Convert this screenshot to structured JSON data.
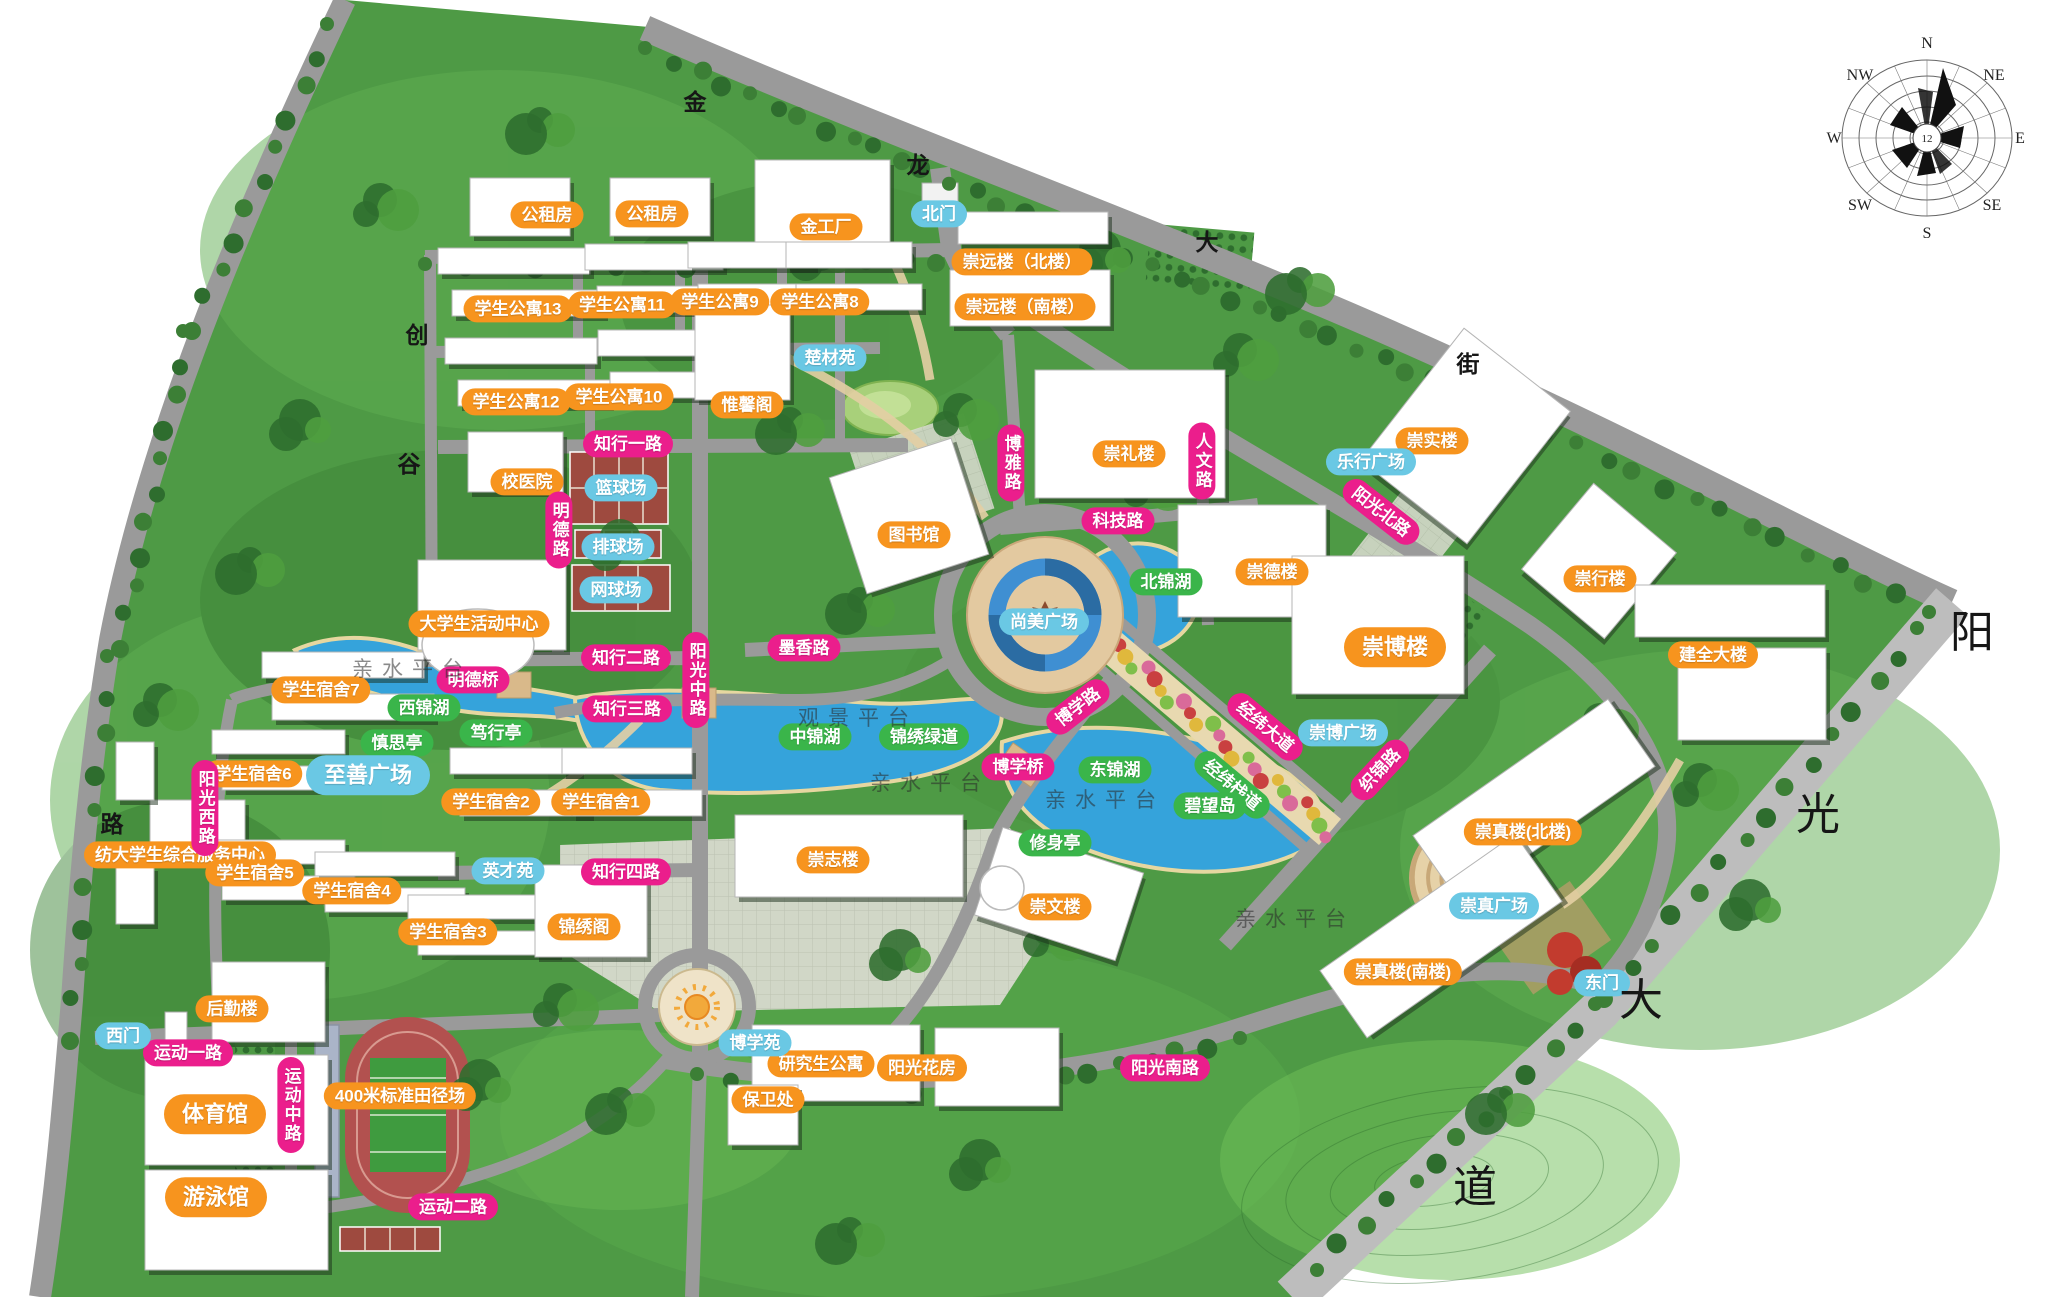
{
  "compass": {
    "directions": [
      "N",
      "NE",
      "E",
      "SE",
      "S",
      "SW",
      "W",
      "NW"
    ],
    "center_value": "12"
  },
  "labels": {
    "buildings": [
      {
        "t": "公租房",
        "x": 547,
        "y": 215
      },
      {
        "t": "公租房",
        "x": 652,
        "y": 214
      },
      {
        "t": "金工厂",
        "x": 826,
        "y": 227
      },
      {
        "t": "学生公寓13",
        "x": 518,
        "y": 309
      },
      {
        "t": "学生公寓11",
        "x": 622,
        "y": 305
      },
      {
        "t": "学生公寓9",
        "x": 720,
        "y": 302
      },
      {
        "t": "学生公寓8",
        "x": 820,
        "y": 302
      },
      {
        "t": "崇远楼（北楼）",
        "x": 1022,
        "y": 262
      },
      {
        "t": "崇远楼（南楼）",
        "x": 1025,
        "y": 307
      },
      {
        "t": "学生公寓12",
        "x": 516,
        "y": 402
      },
      {
        "t": "学生公寓10",
        "x": 619,
        "y": 397
      },
      {
        "t": "惟馨阁",
        "x": 747,
        "y": 405
      },
      {
        "t": "校医院",
        "x": 527,
        "y": 482
      },
      {
        "t": "崇礼楼",
        "x": 1129,
        "y": 454
      },
      {
        "t": "崇实楼",
        "x": 1432,
        "y": 441
      },
      {
        "t": "图书馆",
        "x": 914,
        "y": 535
      },
      {
        "t": "崇德楼",
        "x": 1272,
        "y": 572
      },
      {
        "t": "崇博楼",
        "x": 1395,
        "y": 647,
        "s": "lg"
      },
      {
        "t": "崇行楼",
        "x": 1600,
        "y": 579
      },
      {
        "t": "建全大楼",
        "x": 1713,
        "y": 655
      },
      {
        "t": "大学生活动中心",
        "x": 479,
        "y": 624
      },
      {
        "t": "学生宿舍7",
        "x": 321,
        "y": 690
      },
      {
        "t": "学生宿舍6",
        "x": 253,
        "y": 774
      },
      {
        "t": "纺大学生综合服务中心",
        "x": 180,
        "y": 855
      },
      {
        "t": "学生宿舍5",
        "x": 255,
        "y": 873
      },
      {
        "t": "学生宿舍4",
        "x": 352,
        "y": 891
      },
      {
        "t": "学生宿舍3",
        "x": 448,
        "y": 932
      },
      {
        "t": "学生宿舍2",
        "x": 491,
        "y": 802
      },
      {
        "t": "学生宿舍1",
        "x": 601,
        "y": 802
      },
      {
        "t": "锦绣阁",
        "x": 584,
        "y": 927
      },
      {
        "t": "崇志楼",
        "x": 833,
        "y": 860
      },
      {
        "t": "崇文楼",
        "x": 1055,
        "y": 907
      },
      {
        "t": "研究生公寓",
        "x": 821,
        "y": 1064
      },
      {
        "t": "阳光花房",
        "x": 922,
        "y": 1068
      },
      {
        "t": "保卫处",
        "x": 768,
        "y": 1100
      },
      {
        "t": "后勤楼",
        "x": 232,
        "y": 1009
      },
      {
        "t": "体育馆",
        "x": 215,
        "y": 1114,
        "s": "lg"
      },
      {
        "t": "游泳馆",
        "x": 216,
        "y": 1197,
        "s": "lg"
      },
      {
        "t": "400米标准田径场",
        "x": 400,
        "y": 1096
      },
      {
        "t": "崇真楼(北楼)",
        "x": 1523,
        "y": 832
      },
      {
        "t": "崇真楼(南楼)",
        "x": 1403,
        "y": 972
      }
    ],
    "roads": [
      {
        "t": "知行一路",
        "x": 628,
        "y": 444
      },
      {
        "t": "明德路",
        "x": 559,
        "y": 530,
        "v": true
      },
      {
        "t": "知行二路",
        "x": 626,
        "y": 658
      },
      {
        "t": "明德桥",
        "x": 473,
        "y": 680
      },
      {
        "t": "知行三路",
        "x": 627,
        "y": 709
      },
      {
        "t": "阳光中路",
        "x": 696,
        "y": 680,
        "v": true
      },
      {
        "t": "墨香路",
        "x": 804,
        "y": 648
      },
      {
        "t": "知行四路",
        "x": 626,
        "y": 872
      },
      {
        "t": "阳光西路",
        "x": 205,
        "y": 808,
        "v": true
      },
      {
        "t": "运动一路",
        "x": 188,
        "y": 1053
      },
      {
        "t": "运动中路",
        "x": 291,
        "y": 1105,
        "v": true
      },
      {
        "t": "运动二路",
        "x": 453,
        "y": 1207
      },
      {
        "t": "博雅路",
        "x": 1011,
        "y": 463,
        "v": true
      },
      {
        "t": "人文路",
        "x": 1202,
        "y": 461,
        "v": true
      },
      {
        "t": "科技路",
        "x": 1118,
        "y": 521
      },
      {
        "t": "阳光北路",
        "x": 1381,
        "y": 512,
        "r": 38
      },
      {
        "t": "博学路",
        "x": 1078,
        "y": 707,
        "r": -38
      },
      {
        "t": "博学桥",
        "x": 1018,
        "y": 767
      },
      {
        "t": "经纬大道",
        "x": 1265,
        "y": 727,
        "r": 40
      },
      {
        "t": "织锦路",
        "x": 1380,
        "y": 770,
        "r": -47
      },
      {
        "t": "阳光南路",
        "x": 1165,
        "y": 1068
      }
    ],
    "nature": [
      {
        "t": "西锦湖",
        "x": 424,
        "y": 708
      },
      {
        "t": "中锦湖",
        "x": 815,
        "y": 737
      },
      {
        "t": "北锦湖",
        "x": 1166,
        "y": 582
      },
      {
        "t": "东锦湖",
        "x": 1115,
        "y": 770
      },
      {
        "t": "慎思亭",
        "x": 397,
        "y": 743
      },
      {
        "t": "笃行亭",
        "x": 496,
        "y": 733
      },
      {
        "t": "修身亭",
        "x": 1055,
        "y": 843
      },
      {
        "t": "锦绣绿道",
        "x": 924,
        "y": 737
      },
      {
        "t": "经纬栈道",
        "x": 1232,
        "y": 785,
        "r": 40
      },
      {
        "t": "碧望岛",
        "x": 1210,
        "y": 806
      }
    ],
    "facilities": [
      {
        "t": "北门",
        "x": 939,
        "y": 214
      },
      {
        "t": "楚材苑",
        "x": 830,
        "y": 358
      },
      {
        "t": "篮球场",
        "x": 621,
        "y": 488
      },
      {
        "t": "排球场",
        "x": 618,
        "y": 547
      },
      {
        "t": "网球场",
        "x": 616,
        "y": 590
      },
      {
        "t": "乐行广场",
        "x": 1371,
        "y": 462
      },
      {
        "t": "尚美广场",
        "x": 1044,
        "y": 622
      },
      {
        "t": "至善广场",
        "x": 368,
        "y": 775,
        "s": "lg"
      },
      {
        "t": "英才苑",
        "x": 508,
        "y": 871
      },
      {
        "t": "博学苑",
        "x": 755,
        "y": 1043
      },
      {
        "t": "崇博广场",
        "x": 1343,
        "y": 733
      },
      {
        "t": "崇真广场",
        "x": 1494,
        "y": 906
      },
      {
        "t": "东门",
        "x": 1602,
        "y": 983
      },
      {
        "t": "西门",
        "x": 123,
        "y": 1036
      }
    ],
    "watermarks": [
      {
        "t": "观景平台",
        "x": 858,
        "y": 717
      },
      {
        "t": "亲水平台",
        "x": 412,
        "y": 668
      },
      {
        "t": "亲水平台",
        "x": 930,
        "y": 782
      },
      {
        "t": "亲水平台",
        "x": 1105,
        "y": 799
      },
      {
        "t": "亲水平台",
        "x": 1295,
        "y": 918
      }
    ],
    "street_names": [
      {
        "t": "金",
        "x": 695,
        "y": 100,
        "size": "sm"
      },
      {
        "t": "龙",
        "x": 918,
        "y": 163,
        "size": "sm"
      },
      {
        "t": "大",
        "x": 1207,
        "y": 240,
        "size": "sm"
      },
      {
        "t": "街",
        "x": 1468,
        "y": 362,
        "size": "sm"
      },
      {
        "t": "创",
        "x": 417,
        "y": 333,
        "size": "sm"
      },
      {
        "t": "谷",
        "x": 409,
        "y": 462,
        "size": "sm"
      },
      {
        "t": "路",
        "x": 112,
        "y": 822,
        "size": "sm"
      },
      {
        "t": "阳",
        "x": 1972,
        "y": 628,
        "size": "bg"
      },
      {
        "t": "光",
        "x": 1818,
        "y": 810,
        "size": "bg"
      },
      {
        "t": "大",
        "x": 1641,
        "y": 996,
        "size": "bg"
      },
      {
        "t": "道",
        "x": 1475,
        "y": 1183,
        "size": "bg"
      }
    ]
  }
}
